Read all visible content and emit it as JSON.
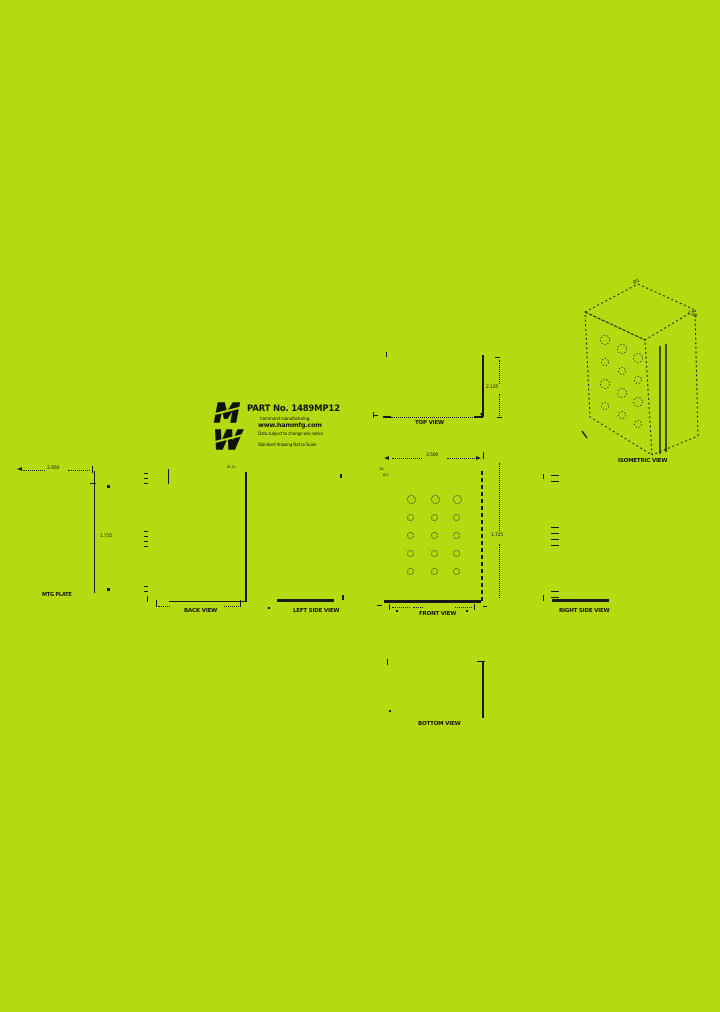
{
  "canvas": {
    "background": "#b6da11",
    "ink": "#141414"
  },
  "title_block": {
    "logo_top_letter": "M",
    "logo_bottom_letter": "W",
    "part_no": "PART No. 1489MP12",
    "company": "hammond manufacturing.",
    "website": "www.hammfg.com",
    "notice": "Data subject to change w/o notice",
    "scale_note": "Standard drawing  Not to Scale"
  },
  "views": {
    "top": {
      "label": "TOP VIEW",
      "depth_dim": "2.125"
    },
    "isometric": {
      "label": "ISOMETRIC VIEW",
      "dim_top": "Ø1",
      "dim_right": "1.00"
    },
    "mtg_plate": {
      "label": "MTG PLATE",
      "width_dim": "2.950",
      "height_dim": "1.725"
    },
    "back": {
      "label": "BACK VIEW",
      "hole_callout": "Ø .11"
    },
    "left_side": {
      "label": "LEFT SIDE VIEW"
    },
    "front": {
      "label": "FRONT VIEW",
      "width_dim": "3.500",
      "height_dim": "1.725",
      "callout_line1": "2X",
      "callout_line2": "Ø.1"
    },
    "right_side": {
      "label": "RIGHT SIDE VIEW"
    },
    "bottom": {
      "label": "BOTTOM VIEW"
    }
  }
}
